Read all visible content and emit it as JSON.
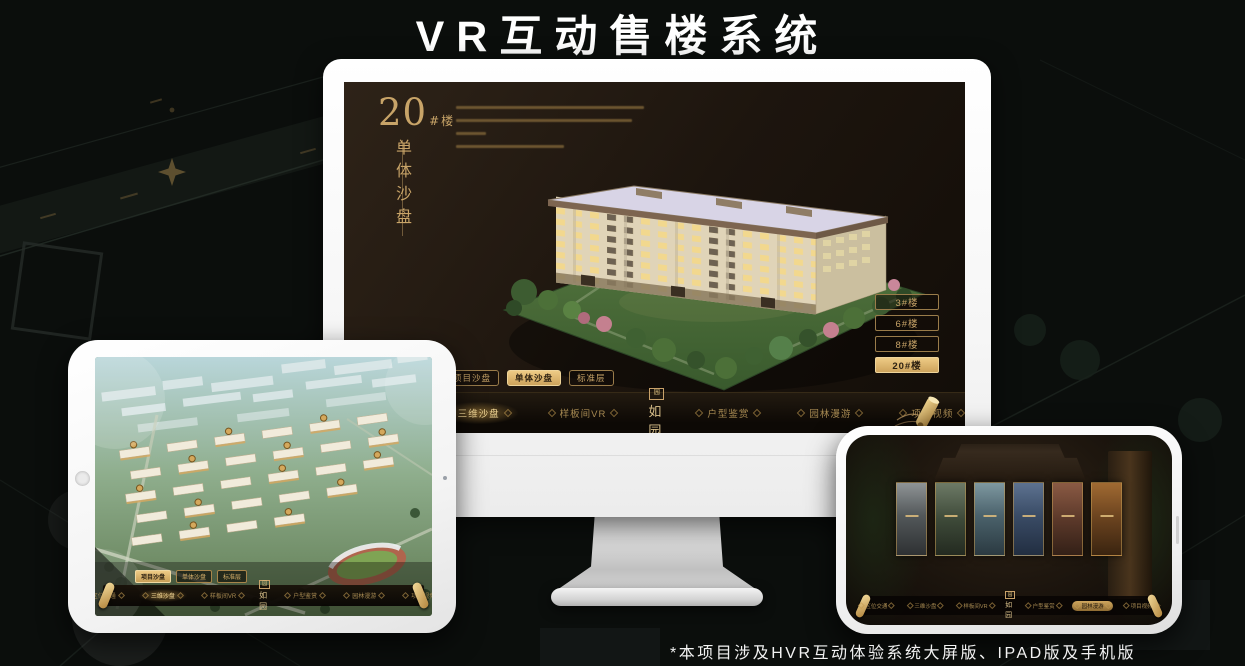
{
  "page": {
    "title": "VR互动售楼系统",
    "footnote": "*本项目涉及HVR互动体验系统大屏版、IPAD版及手机版"
  },
  "colors": {
    "gold": "#c9a26a",
    "gold_bright": "#eecb85",
    "screen_bg": "#1d150e",
    "title_white": "#ffffff"
  },
  "monitor_app": {
    "unit_number": "20",
    "unit_suffix": "#楼",
    "unit_subtitle": "单体沙盘",
    "sub_tabs": [
      {
        "label": "项目沙盘",
        "active": false
      },
      {
        "label": "单体沙盘",
        "active": true
      },
      {
        "label": "标准层",
        "active": false
      }
    ],
    "floor_buttons": [
      {
        "label": "3#楼",
        "active": false
      },
      {
        "label": "6#楼",
        "active": false
      },
      {
        "label": "8#楼",
        "active": false
      },
      {
        "label": "20#楼",
        "active": true
      }
    ],
    "nav_items": [
      {
        "label": "区位交通",
        "active": false
      },
      {
        "label": "三维沙盘",
        "active": true
      },
      {
        "label": "样板间VR",
        "active": false
      },
      {
        "label": "户型鉴赏",
        "active": false
      },
      {
        "label": "园林漫游",
        "active": false
      },
      {
        "label": "项目视频",
        "active": false
      }
    ],
    "logo": {
      "seal": "园",
      "text": "如园"
    }
  },
  "ipad_app": {
    "sub_tabs": [
      {
        "label": "项目沙盘",
        "active": true
      },
      {
        "label": "单体沙盘",
        "active": false
      },
      {
        "label": "标准层",
        "active": false
      }
    ],
    "nav_items": [
      {
        "label": "区位交通",
        "active": false
      },
      {
        "label": "三维沙盘",
        "active": true
      },
      {
        "label": "样板间VR",
        "active": false
      },
      {
        "label": "户型鉴赏",
        "active": false
      },
      {
        "label": "园林漫游",
        "active": false
      },
      {
        "label": "项目视频",
        "active": false
      }
    ],
    "logo": {
      "seal": "园",
      "text": "如园"
    }
  },
  "phone_app": {
    "nav_items": [
      {
        "label": "区位交通",
        "active": false
      },
      {
        "label": "三维沙盘",
        "active": false
      },
      {
        "label": "样板间VR",
        "active": false
      },
      {
        "label": "户型鉴赏",
        "active": false
      },
      {
        "label": "园林漫游",
        "active": true
      },
      {
        "label": "项目视频",
        "active": false
      }
    ],
    "logo": {
      "seal": "园",
      "text": "如园"
    }
  }
}
